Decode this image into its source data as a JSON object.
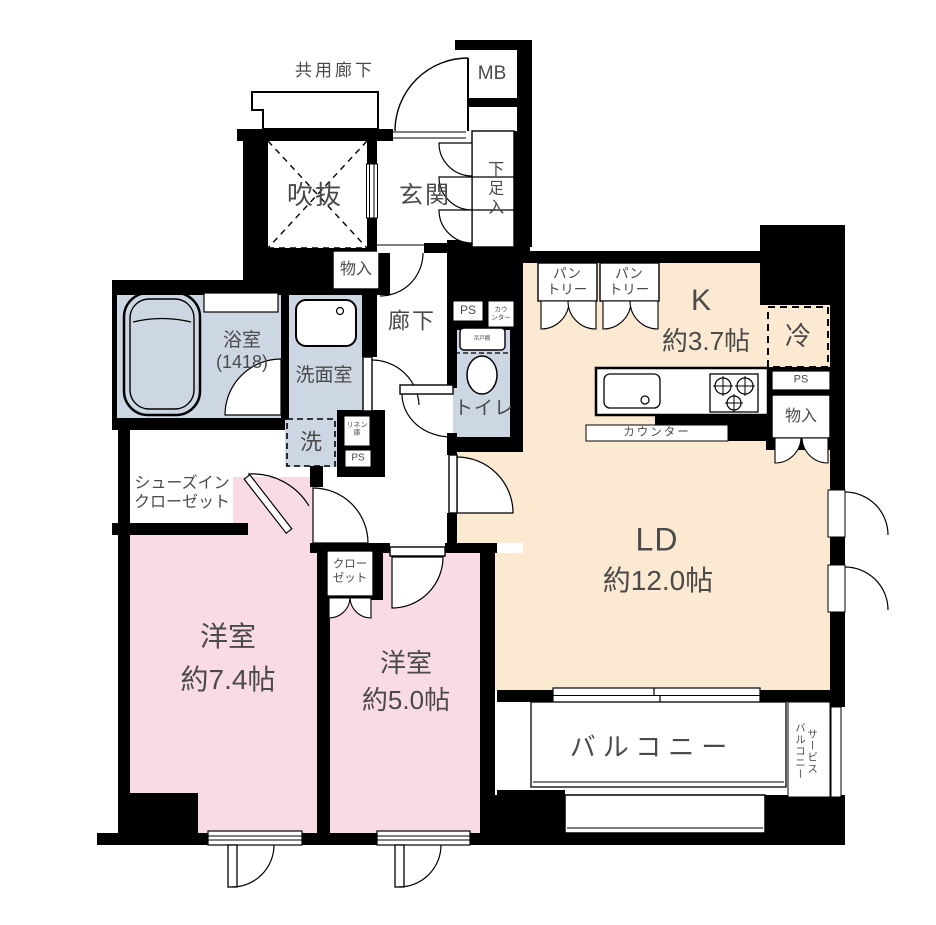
{
  "floorplan": {
    "labels": {
      "shared_corridor": "共用廊下",
      "mb": "MB",
      "void": "吹抜",
      "entrance": "玄関",
      "shoe_cabinet": "下足入",
      "storage_hall": "物入",
      "hallway": "廊下",
      "bathroom_l1": "浴室",
      "bathroom_l2": "(1418)",
      "washroom": "洗面室",
      "washer": "洗",
      "linen_l1": "リネン",
      "linen_l2": "庫",
      "ps": "PS",
      "toilet": "トイレ",
      "toilet_counter_l1": "カウ",
      "toilet_counter_l2": "ンター",
      "toilet_shelf": "吊戸棚",
      "pantry_l1": "パン",
      "pantry_l2": "トリー",
      "kitchen_l1": "K",
      "kitchen_l2": "約3.7帖",
      "fridge": "冷",
      "storage_kitchen": "物入",
      "counter": "カウンター",
      "ld_l1": "LD",
      "ld_l2": "約12.0帖",
      "shoes_closet_l1": "シューズイン",
      "shoes_closet_l2": "クローゼット",
      "closet_l1": "クロー",
      "closet_l2": "ゼット",
      "bedroom1_l1": "洋室",
      "bedroom1_l2": "約7.4帖",
      "bedroom2_l1": "洋室",
      "bedroom2_l2": "約5.0帖",
      "balcony": "バルコニー",
      "service_balcony_l1": "サービス",
      "service_balcony_l2": "バルコニー"
    },
    "colors": {
      "wall": "#000000",
      "bedroom_fill": "#f9dbe3",
      "living_fill": "#fbe9d1",
      "sanitary_fill": "#cdd7e3",
      "text": "#4a4a4a"
    }
  }
}
